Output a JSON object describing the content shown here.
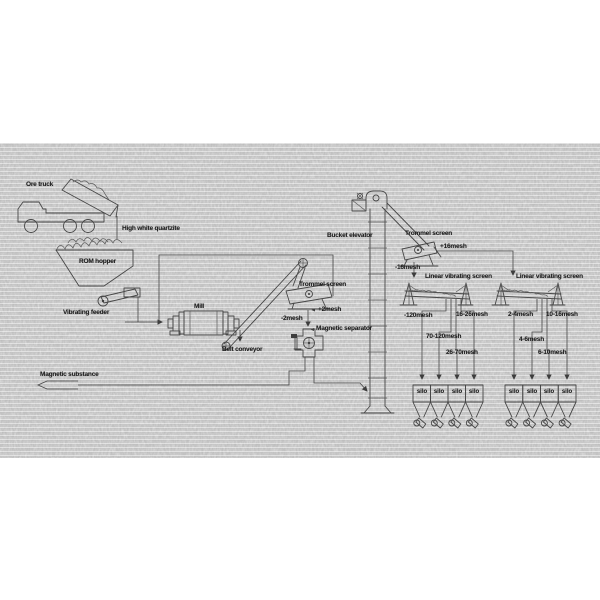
{
  "diagram": {
    "type": "mineral-processing-flowsheet",
    "labels": {
      "ore_truck": "Ore truck",
      "high_white_quartzite": "High white quartzite",
      "rom_hopper": "ROM hopper",
      "vibrating_feeder": "Vibrating feeder",
      "mill": "Mill",
      "belt_conveyor": "Belt conveyor",
      "trommel_screen_1": "Trommel screen",
      "plus_2mesh": "+2mesh",
      "minus_2mesh": "-2mesh",
      "magnetic_separator": "Magnetic separator",
      "magnetic_substance": "Magnetic substance",
      "bucket_elevator": "Bucket elevator",
      "trommel_screen_2": "Trommel screen",
      "plus_16mesh": "+16mesh",
      "minus_16mesh": "-16mesh",
      "linear_vibrating_screen_1": "Linear vibrating screen",
      "linear_vibrating_screen_2": "Linear vibrating screen",
      "mesh_neg_120": "-120mesh",
      "mesh_16_26": "16-26mesh",
      "mesh_70_120": "70-120mesh",
      "mesh_26_70": "26-70mesh",
      "mesh_2_4": "2-4mesh",
      "mesh_10_16": "10-16mesh",
      "mesh_4_6": "4-6mesh",
      "mesh_6_10": "6-10mesh"
    },
    "silos": [
      "silo",
      "silo",
      "silo",
      "silo",
      "silo",
      "silo",
      "silo",
      "silo"
    ],
    "machine_icons": [
      "ore-truck",
      "rom-hopper",
      "vibrating-feeder",
      "mill",
      "belt-conveyor",
      "trommel-screen",
      "magnetic-separator",
      "bucket-elevator",
      "trommel-screen",
      "linear-vibrating-screen",
      "linear-vibrating-screen",
      "silo"
    ],
    "colors": {
      "line": "#474747",
      "label": "#1d1d1d",
      "paper": "#e9e9e9",
      "page": "#ffffff"
    }
  }
}
